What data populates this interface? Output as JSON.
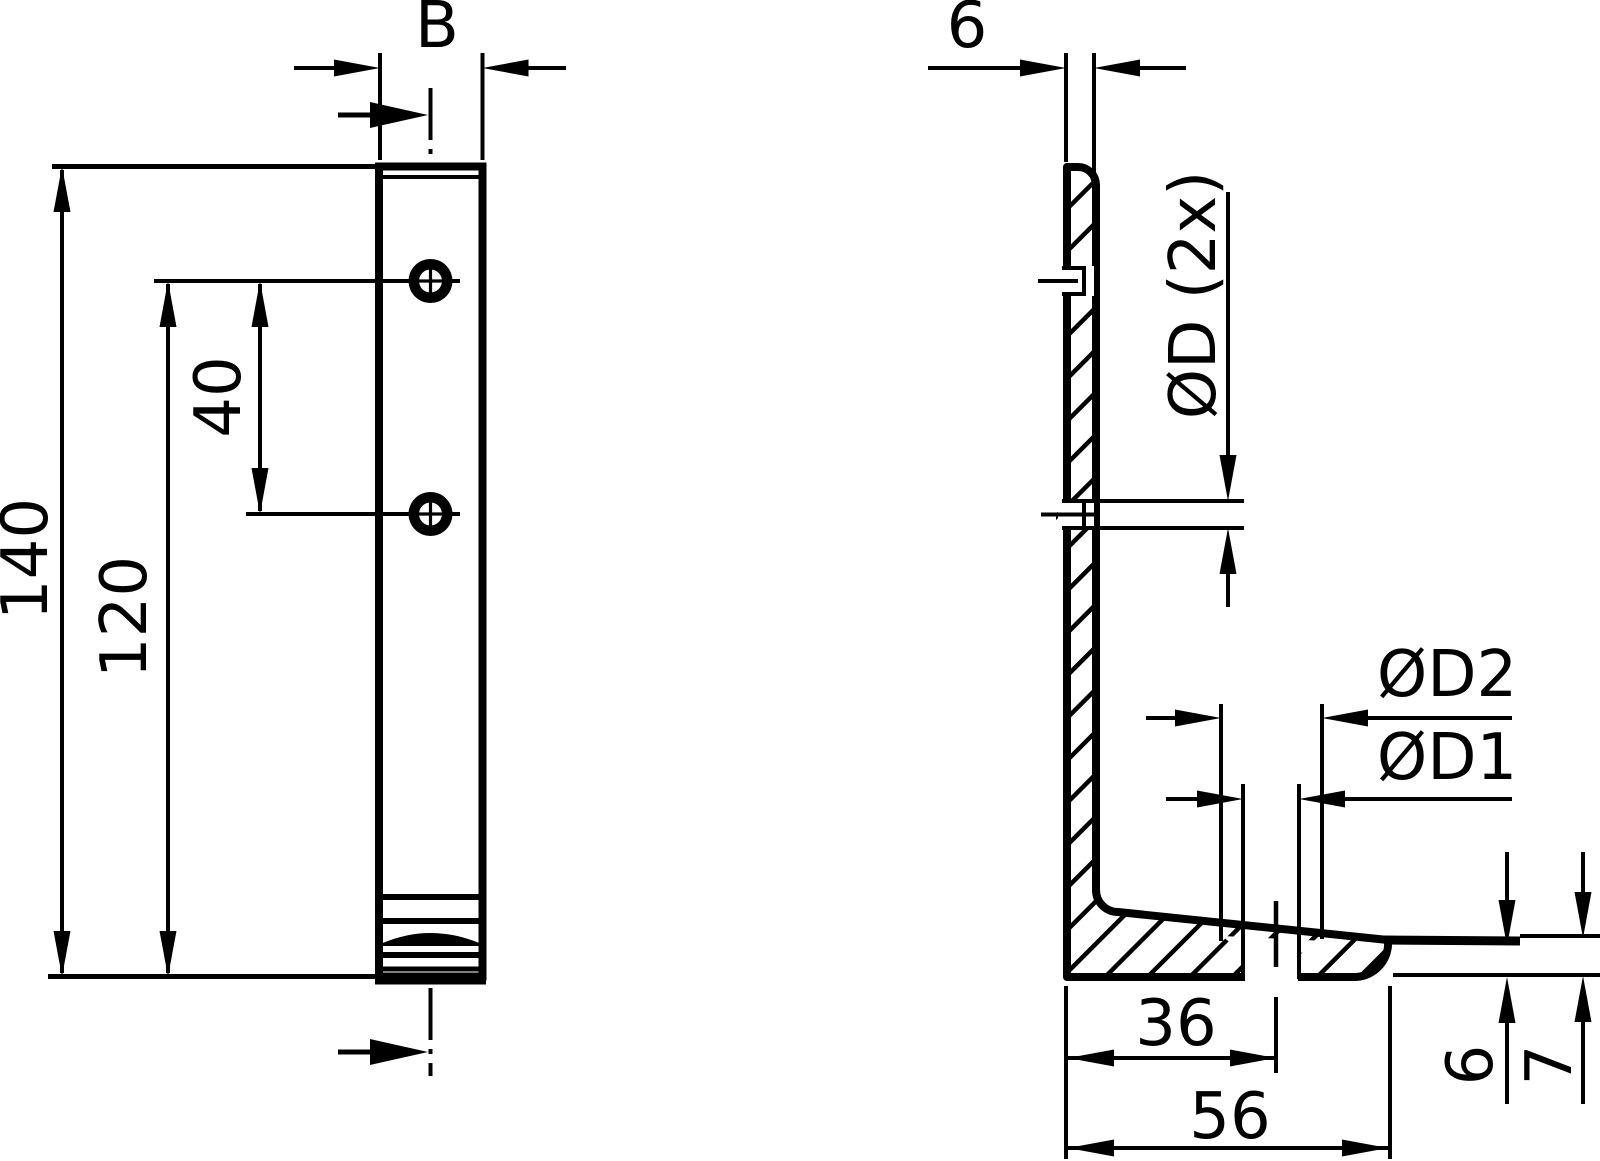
{
  "drawing_labels": {
    "front_view": {
      "width": "B",
      "total_height": "140",
      "hole_to_bottom": "120",
      "hole_spacing": "40"
    },
    "section_view": {
      "wall_thickness": "6",
      "wall_holes": "ØD (2x)",
      "base_hole_countersink": "ØD2",
      "base_hole": "ØD1",
      "hole_offset": "36",
      "base_width": "56",
      "tip_thickness": "6",
      "base_thickness": "7"
    }
  },
  "colors": {
    "line": "#000000",
    "background": "#ffffff"
  }
}
